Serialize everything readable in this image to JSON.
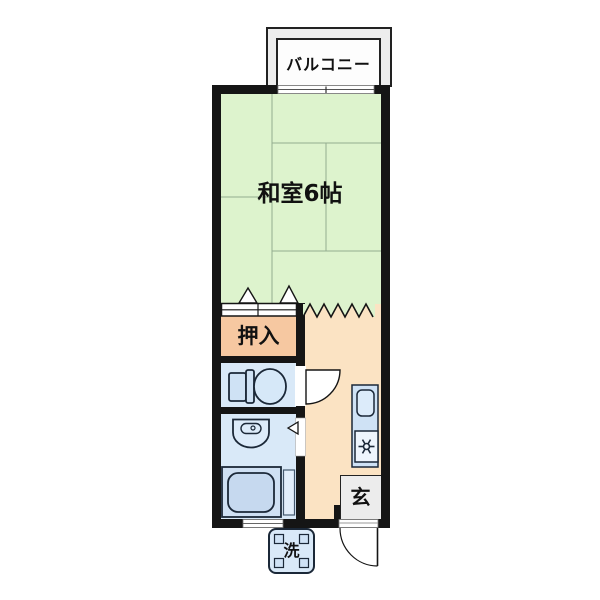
{
  "title": "1K apartment floor plan",
  "rooms": {
    "balcony": {
      "label": "バルコニー"
    },
    "washitsu": {
      "label": "和室6帖"
    },
    "oshiire": {
      "label": "押入"
    },
    "genkan": {
      "label": "玄"
    },
    "washer": {
      "label": "洗"
    }
  },
  "icons": {
    "toilet": "toilet-plan-symbol",
    "bathtub": "bathtub-plan-symbol",
    "washbasin": "washbasin-plan-symbol",
    "kitchen_sink": "sink-plan-symbol",
    "stove_burner": "burner-asterisk-symbol",
    "door_swing": "quarter-arc-door-symbol",
    "sliding_door": "double-panel-fusuma-symbol",
    "open_boundary": "zigzag-partition-symbol",
    "washing_machine": "washer-pan-symbol",
    "window": "double-line-window-symbol"
  },
  "colors": {
    "tatami_green": "#ddf3cd",
    "hall_orange": "#fbe3c3",
    "closet_salmon": "#f6c8a1",
    "wet_area_blue": "#d9e9f8",
    "fixture_blue": "#cfe2f5",
    "genkan_gray": "#ececec",
    "balcony_gray": "#ededed",
    "wall_black": "#151515"
  }
}
